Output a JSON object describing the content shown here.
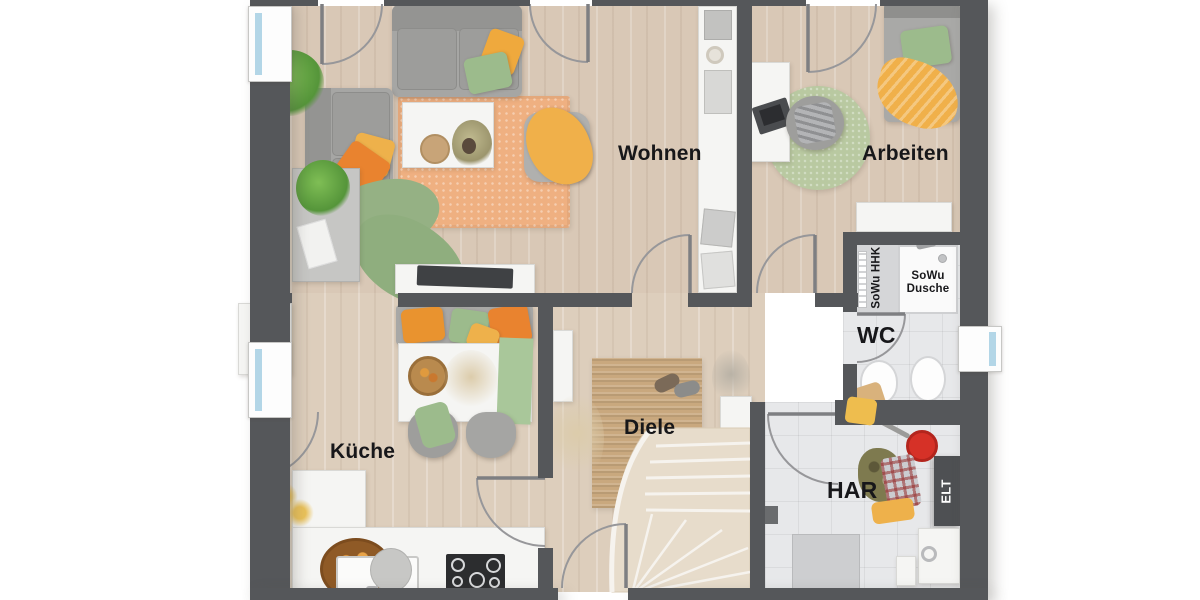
{
  "floorplan": {
    "room_labels": {
      "wohnen": "Wohnen",
      "arbeiten": "Arbeiten",
      "kueche": "Küche",
      "diele": "Diele",
      "wc": "WC",
      "har": "HAR"
    },
    "fixture_labels": {
      "sowu_hhk": "SoWu HHK",
      "sowu_dusche_line1": "SoWu",
      "sowu_dusche_line2": "Dusche",
      "elt": "ELT"
    },
    "colors": {
      "wall": "#55575a",
      "wood_floor": "#d9c8b6",
      "tile_floor": "#e7e8ea",
      "living_rug": "#efb081",
      "round_rug": "#b9c9a1",
      "jute_rug": "#c9a87e",
      "accent_orange": "#e9832f",
      "accent_yellow": "#efac45",
      "accent_green": "#9cbb8c",
      "fixture_red": "#d63127"
    }
  }
}
